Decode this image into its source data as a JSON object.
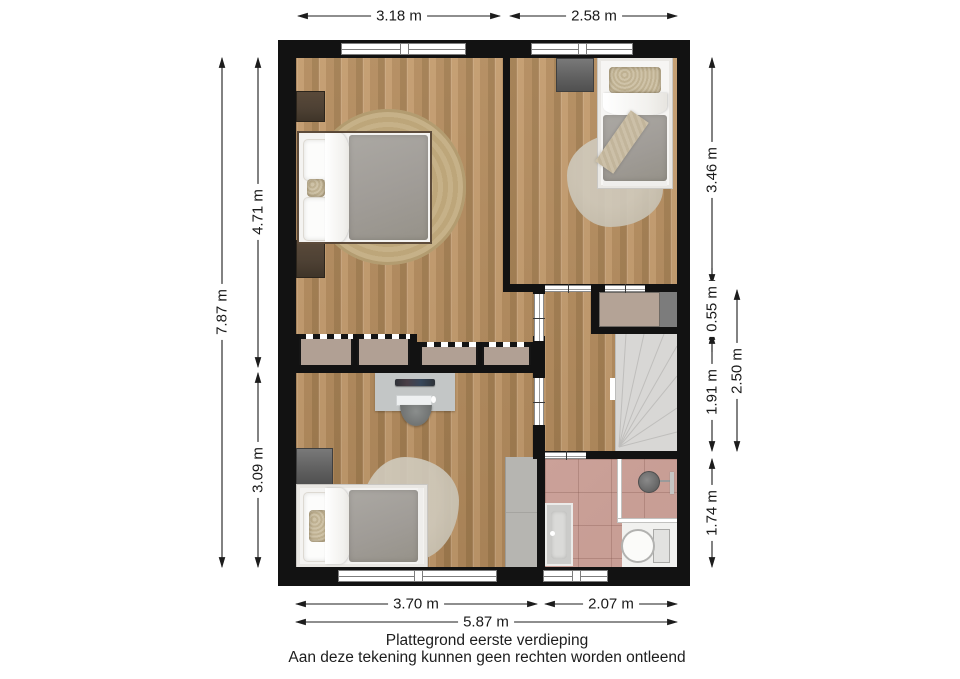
{
  "caption": {
    "line1": "Plattegrond eerste verdieping",
    "line2": "Aan deze tekening kunnen geen rechten worden ontleend"
  },
  "dimensions": {
    "top": [
      {
        "label": "3.18 m"
      },
      {
        "label": "2.58 m"
      }
    ],
    "left": [
      {
        "label": "7.87 m"
      },
      {
        "label": "4.71 m"
      },
      {
        "label": "3.09 m"
      }
    ],
    "right": [
      {
        "label": "3.46 m"
      },
      {
        "label": "0.55 m"
      },
      {
        "label": "1.91 m"
      },
      {
        "label": "1.74 m"
      },
      {
        "label": "2.50 m"
      }
    ],
    "bottom": [
      {
        "label": "3.70 m"
      },
      {
        "label": "2.07 m"
      },
      {
        "label": "5.87 m"
      }
    ]
  },
  "colors": {
    "wall": "#121212",
    "wood-light": "#c29a6c",
    "wood-mid": "#b28a5c",
    "wood-dark": "#a17c4f",
    "closet": "#b1a094",
    "cabinet-beige": "#b4a396",
    "stairs": "#d8d7d5",
    "tile": "#c89e95",
    "duvet": "#a09c97",
    "rug-jute": "#c6b188",
    "rug-sheepskin": "#c7c1b2",
    "desk": "#c3c6c6",
    "nightstand": "#4e4134",
    "dim-text": "#1a1a1a"
  }
}
